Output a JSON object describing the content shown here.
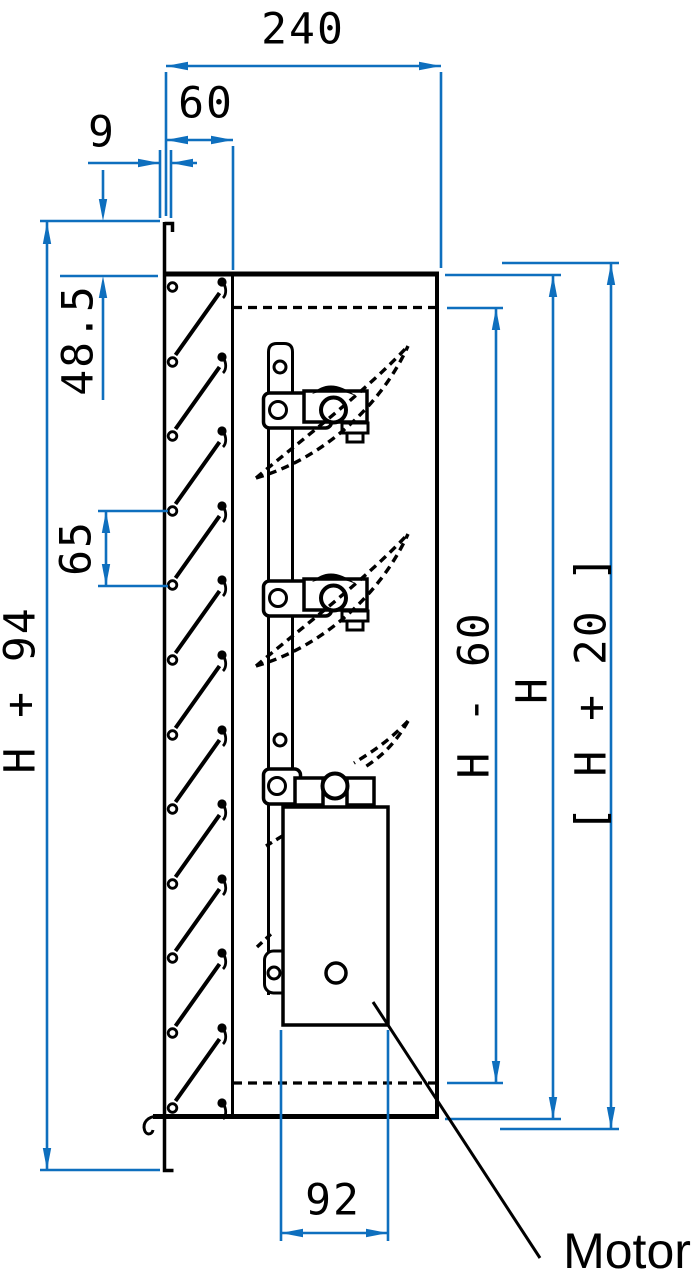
{
  "drawing": {
    "kind": "louvre-damper-section-technical-drawing",
    "dimensions": {
      "overall_depth": "240",
      "louvre_depth": "60",
      "flange_lip": "9",
      "flange_offset": "48.5",
      "louvre_pitch": "65",
      "overall_height": "H + 94",
      "blade_zone_height": "H - 60",
      "duct_height": "H",
      "installation_height": "[ H + 20 ]",
      "motor_width": "92"
    },
    "callouts": {
      "motor": "Motor"
    },
    "colors": {
      "dimension": "#0e6fbe",
      "lines": "#000000",
      "background": "#ffffff"
    }
  }
}
